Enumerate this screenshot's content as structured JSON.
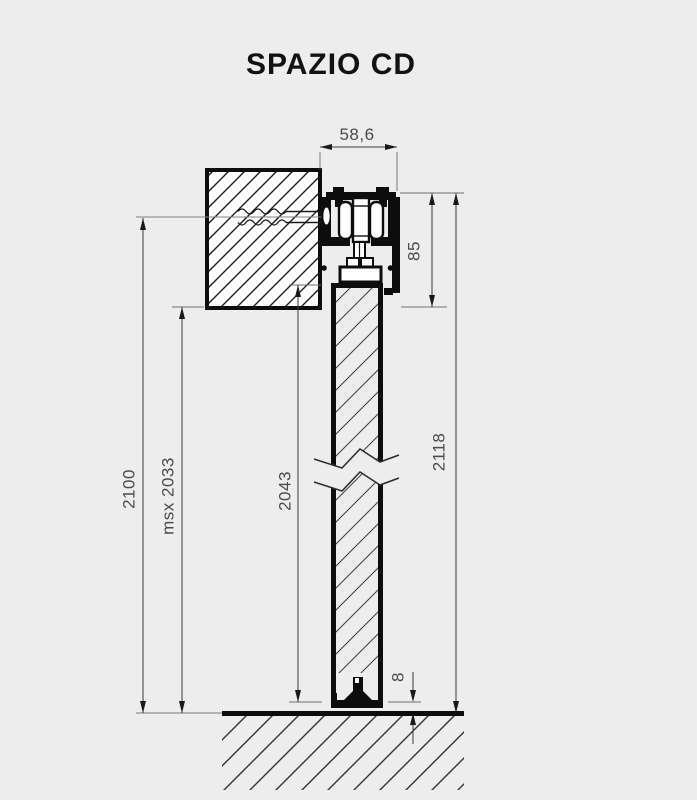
{
  "title": "SPAZIO CD",
  "dimensions": {
    "track_width": "58,6",
    "header_height": "85",
    "system_height": "2118",
    "opening_height": "2100",
    "max_door_height": "msx 2033",
    "door_height": "2043",
    "floor_gap": "8"
  },
  "colors": {
    "background": "#ededed",
    "line": "#0d0d0d",
    "dim_text": "#4b4b4b"
  }
}
